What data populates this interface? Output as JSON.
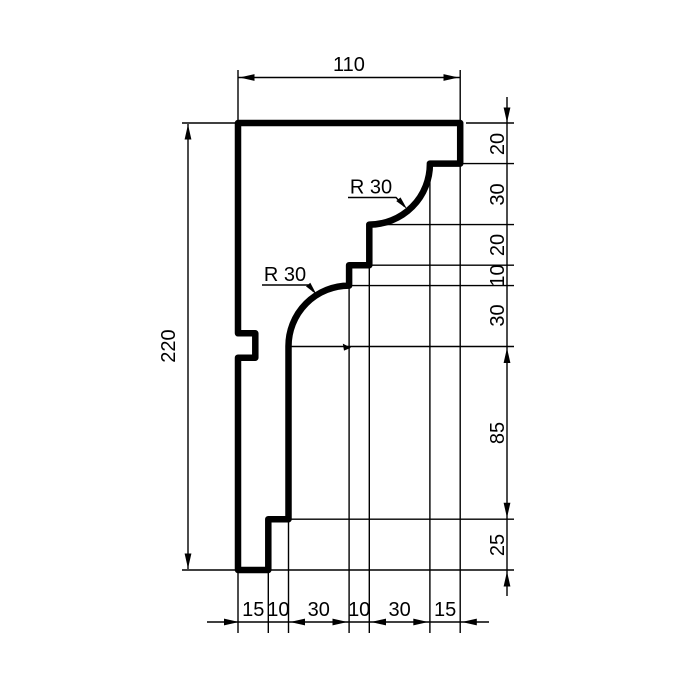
{
  "drawing": {
    "type": "technical-section-profile",
    "units_implied": "mm",
    "colors": {
      "line": "#000000",
      "background": "#ffffff"
    },
    "overall": {
      "width": "110",
      "height": "220"
    },
    "dims": {
      "top": "110",
      "left": "220",
      "right": [
        "20",
        "30",
        "20",
        "10",
        "30",
        "85",
        "25"
      ],
      "bottom": [
        "15",
        "10",
        "30",
        "10",
        "30",
        "15"
      ],
      "radius1": "R 30",
      "radius2": "R 30"
    }
  }
}
